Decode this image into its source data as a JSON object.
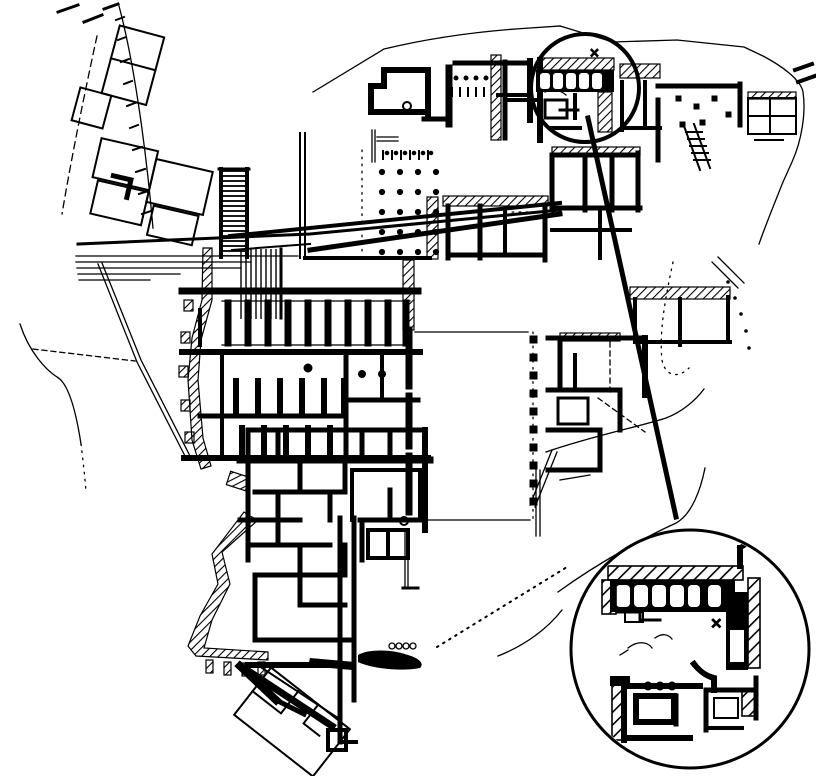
{
  "figure": {
    "kind": "archaeological-excavation-plan",
    "marks": {
      "site_detail_cross": "×",
      "inset_cross": "×"
    }
  },
  "colors": {
    "ink": "#000000",
    "paper": "#ffffff"
  },
  "icons": {
    "detail_circle": "detail-highlight-circle",
    "inset_circle": "magnified-inset-circle",
    "leader_line": "callout-leader-line",
    "column_base_dot": "column-base-dot",
    "hatched_wall": "hatched-wall",
    "causeway": "paved-causeway-lines"
  }
}
